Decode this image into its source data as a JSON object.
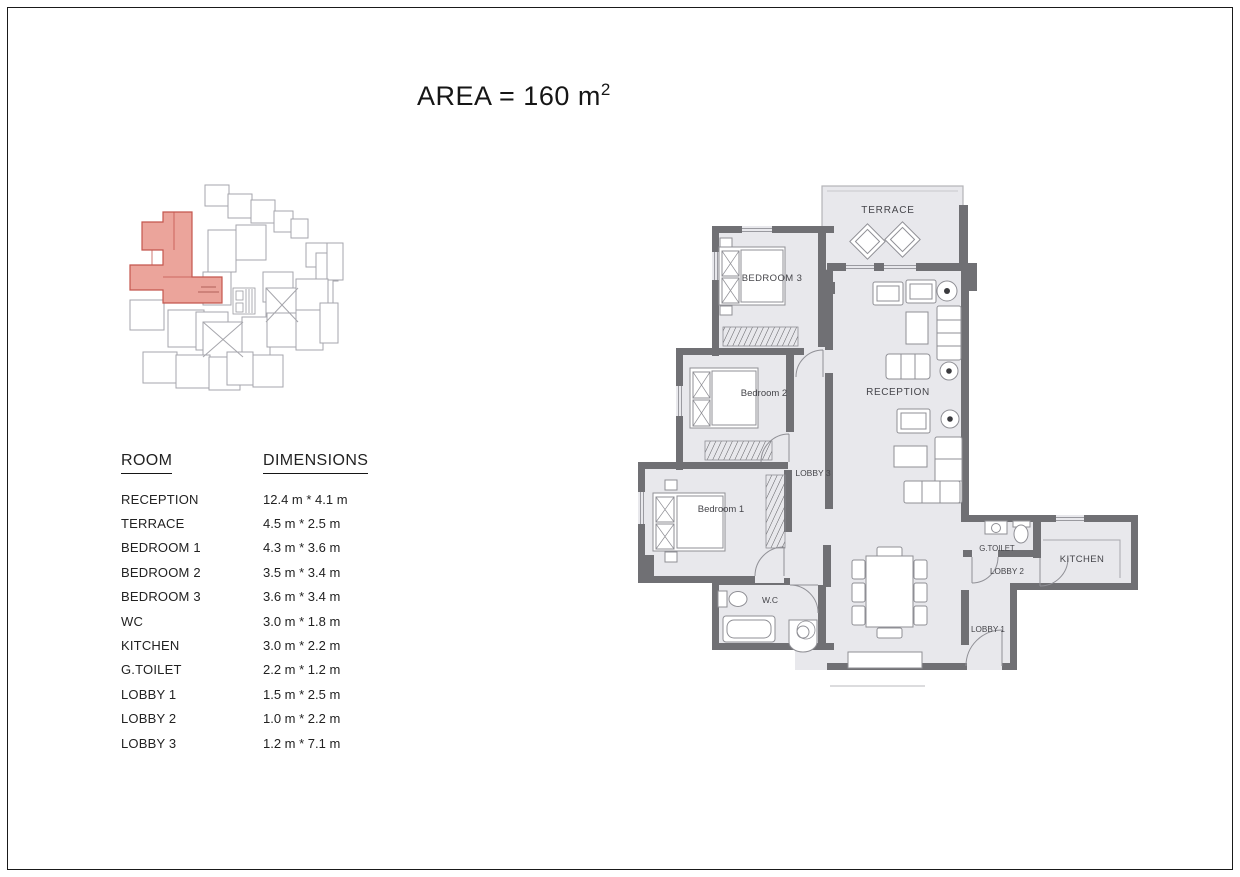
{
  "title": {
    "text": "AREA = 160 m",
    "sup": "2"
  },
  "table": {
    "headers": [
      "ROOM",
      "DIMENSIONS"
    ],
    "rows": [
      {
        "room": "RECEPTION",
        "dim": "12.4 m * 4.1 m"
      },
      {
        "room": "TERRACE",
        "dim": "4.5 m * 2.5 m"
      },
      {
        "room": "BEDROOM 1",
        "dim": "4.3 m * 3.6 m"
      },
      {
        "room": "BEDROOM 2",
        "dim": "3.5 m * 3.4 m"
      },
      {
        "room": "BEDROOM 3",
        "dim": "3.6 m * 3.4 m"
      },
      {
        "room": "WC",
        "dim": "3.0 m * 1.8 m"
      },
      {
        "room": "KITCHEN",
        "dim": "3.0 m * 2.2 m"
      },
      {
        "room": "G.TOILET",
        "dim": "2.2 m * 1.2 m"
      },
      {
        "room": "LOBBY 1",
        "dim": "1.5 m * 2.5 m"
      },
      {
        "room": "LOBBY 2",
        "dim": "1.0 m * 2.2 m"
      },
      {
        "room": "LOBBY 3",
        "dim": "1.2 m * 7.1 m"
      }
    ]
  },
  "floor_plan": {
    "labels": {
      "terrace": "TERRACE",
      "bedroom3": "BEDROOM 3",
      "bedroom2": "Bedroom 2",
      "bedroom1": "Bedroom 1",
      "reception": "RECEPTION",
      "lobby3": "LOBBY 3",
      "wc": "W.C",
      "g_toilet": "G.TOILET",
      "lobby2": "LOBBY 2",
      "kitchen": "KITCHEN",
      "lobby1": "LOBBY 1"
    }
  },
  "colors": {
    "wall": "#707074",
    "floor": "#e8e8ec",
    "highlight": "#eba49b",
    "highlight_line": "#c4564e",
    "keyplan_line": "#a6a6ac"
  }
}
